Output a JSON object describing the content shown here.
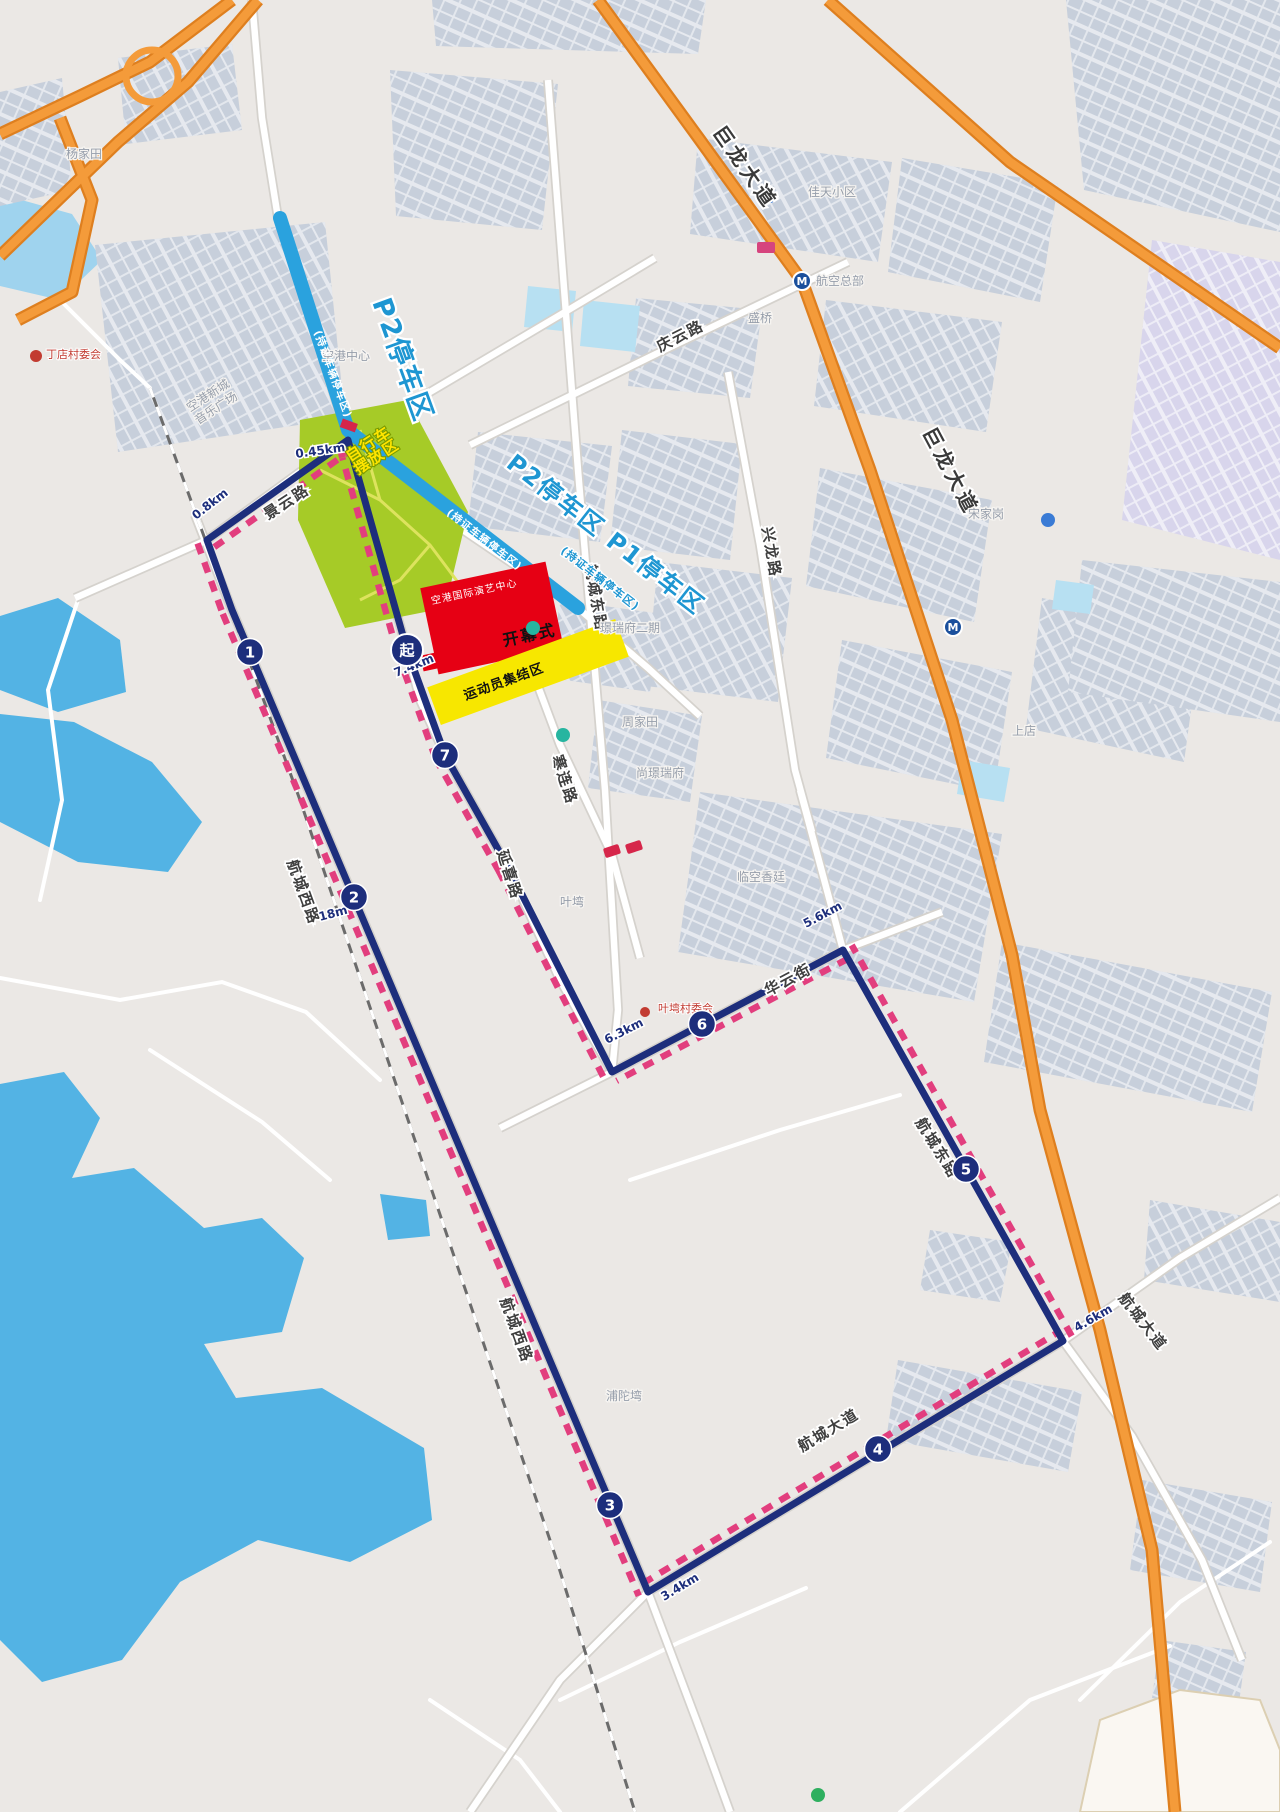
{
  "map_colors": {
    "land": "#ebe8e5",
    "building_zone": "#c7cfdb",
    "building_zone_lavender": "#d8d5ec",
    "water": "#53b3e4",
    "water_light": "#9fd3ee",
    "pond_cell": "#b7e0f2",
    "highway_orange": "#f49b3a",
    "highway_casing": "#de7f1f",
    "route_navy": "#1d2e7c",
    "closure_pink": "#e23e7e",
    "parking_blue": "#2aa2de",
    "park_green": "#a6cb27",
    "ceremony_red": "#e60014",
    "assembly_yellow": "#f7e700",
    "railway_gray": "#6b6b6b"
  },
  "route": {
    "polyline": [
      [
        407,
        650
      ],
      [
        352,
        455
      ],
      [
        348,
        440
      ],
      [
        207,
        540
      ],
      [
        232,
        610
      ],
      [
        648,
        1592
      ],
      [
        1063,
        1341
      ],
      [
        843,
        950
      ],
      [
        612,
        1072
      ],
      [
        508,
        867
      ],
      [
        445,
        755
      ],
      [
        407,
        650
      ]
    ],
    "closure_sides": [
      "L",
      "L",
      "L",
      "R",
      "R",
      "L",
      "R",
      "L",
      "L",
      "L",
      "L"
    ],
    "start_marker": {
      "label": "起",
      "x": 407,
      "y": 650
    },
    "km_markers": [
      {
        "label": "1",
        "x": 250,
        "y": 652
      },
      {
        "label": "2",
        "x": 354,
        "y": 897
      },
      {
        "label": "3",
        "x": 610,
        "y": 1505
      },
      {
        "label": "4",
        "x": 878,
        "y": 1449
      },
      {
        "label": "5",
        "x": 966,
        "y": 1169
      },
      {
        "label": "6",
        "x": 702,
        "y": 1024
      },
      {
        "label": "7",
        "x": 445,
        "y": 755
      }
    ],
    "distance_labels": [
      {
        "text": "0.45km",
        "x": 296,
        "y": 458,
        "angle": -8
      },
      {
        "text": "0.8km",
        "x": 196,
        "y": 520,
        "angle": -38
      },
      {
        "text": "7.4km",
        "x": 396,
        "y": 677,
        "angle": -22
      },
      {
        "text": "18m",
        "x": 320,
        "y": 921,
        "angle": -15
      },
      {
        "text": "6.3km",
        "x": 607,
        "y": 1044,
        "angle": -27
      },
      {
        "text": "5.6km",
        "x": 806,
        "y": 928,
        "angle": -28
      },
      {
        "text": "4.6km",
        "x": 1077,
        "y": 1332,
        "angle": -30
      },
      {
        "text": "3.4km",
        "x": 664,
        "y": 1601,
        "angle": -31
      }
    ]
  },
  "parking": {
    "corridors": [
      {
        "x1": 280,
        "y1": 218,
        "x2": 348,
        "y2": 430,
        "big_label": "P2停车区",
        "big_x": 372,
        "big_y": 302,
        "big_angle": 70,
        "big_size": 27,
        "inner_label": "(持证车辆停车区)",
        "inner_x": 314,
        "inner_y": 332,
        "inner_angle": 70
      },
      {
        "x1": 350,
        "y1": 432,
        "x2": 578,
        "y2": 608,
        "big_label": "P2停车区 P1停车区",
        "big_x": 505,
        "big_y": 466,
        "big_angle": 38,
        "big_size": 24,
        "inner_label": "(持证车辆停车区)",
        "inner_x": 446,
        "inner_y": 514,
        "inner_angle": 38,
        "extra_label": "(持证车辆停车区)",
        "extra_x": 560,
        "extra_y": 552,
        "extra_angle": 38
      }
    ]
  },
  "venues": {
    "park": {
      "name": "香虹公园",
      "x": 382,
      "y": 528,
      "angle": -15
    },
    "bike_zone": {
      "lines": [
        "自行车",
        "摆放区"
      ],
      "x": 350,
      "y": 462,
      "angle": -33
    },
    "ceremony": {
      "name": "开幕式",
      "venue": "空港国际演艺中心",
      "cx": 492,
      "cy": 618,
      "w": 128,
      "h": 88,
      "angle": -12
    },
    "assembly": {
      "name": "运动员集结区",
      "cx": 528,
      "cy": 672,
      "w": 200,
      "h": 40,
      "angle": -20
    }
  },
  "road_labels": [
    {
      "text": "景云路",
      "x": 268,
      "y": 520,
      "angle": -33,
      "big": false
    },
    {
      "text": "航城西路",
      "x": 287,
      "y": 862,
      "angle": 70,
      "big": false
    },
    {
      "text": "航城西路",
      "x": 500,
      "y": 1300,
      "angle": 70,
      "big": false
    },
    {
      "text": "延喜路",
      "x": 497,
      "y": 852,
      "angle": 72,
      "big": false
    },
    {
      "text": "寒连路",
      "x": 552,
      "y": 757,
      "angle": 72,
      "big": false
    },
    {
      "text": "航城东路",
      "x": 585,
      "y": 565,
      "angle": 80,
      "big": false
    },
    {
      "text": "航城东路",
      "x": 915,
      "y": 1122,
      "angle": 58,
      "big": false
    },
    {
      "text": "庆云路",
      "x": 660,
      "y": 352,
      "angle": -27,
      "big": false
    },
    {
      "text": "兴龙路",
      "x": 762,
      "y": 528,
      "angle": 80,
      "big": false
    },
    {
      "text": "华云街",
      "x": 768,
      "y": 996,
      "angle": -28,
      "big": false
    },
    {
      "text": "航城大道",
      "x": 802,
      "y": 1452,
      "angle": -31,
      "big": false
    },
    {
      "text": "航城大道",
      "x": 1118,
      "y": 1298,
      "angle": 52,
      "big": false
    },
    {
      "text": "巨龙大道",
      "x": 712,
      "y": 132,
      "angle": 55,
      "big": true
    },
    {
      "text": "巨龙大道",
      "x": 922,
      "y": 432,
      "angle": 62,
      "big": true
    }
  ],
  "place_labels": [
    {
      "lines": [
        "空港新城",
        "音乐广场"
      ],
      "x": 190,
      "y": 412,
      "angle": -33
    },
    {
      "lines": [
        "空港中心"
      ],
      "x": 322,
      "y": 360,
      "angle": 0
    },
    {
      "lines": [
        "杨家田"
      ],
      "x": 66,
      "y": 158,
      "angle": 0
    },
    {
      "lines": [
        "佳天小区"
      ],
      "x": 808,
      "y": 196,
      "angle": 0
    },
    {
      "lines": [
        "盛桥"
      ],
      "x": 748,
      "y": 322,
      "angle": 0
    },
    {
      "lines": [
        "璟瑞府二期"
      ],
      "x": 600,
      "y": 632,
      "angle": 0
    },
    {
      "lines": [
        "尚璟瑞府"
      ],
      "x": 636,
      "y": 777,
      "angle": 0
    },
    {
      "lines": [
        "周家田"
      ],
      "x": 622,
      "y": 726,
      "angle": 0
    },
    {
      "lines": [
        "叶塆"
      ],
      "x": 560,
      "y": 906,
      "angle": 0
    },
    {
      "lines": [
        "临空香廷"
      ],
      "x": 737,
      "y": 881,
      "angle": 0
    },
    {
      "lines": [
        "上店"
      ],
      "x": 1012,
      "y": 735,
      "angle": 0
    },
    {
      "lines": [
        "浦陀塆"
      ],
      "x": 606,
      "y": 1400,
      "angle": 0
    },
    {
      "lines": [
        "宋家岗"
      ],
      "x": 968,
      "y": 518,
      "angle": 0
    }
  ],
  "poi_labels": [
    {
      "text": "丁店村委会",
      "x": 46,
      "y": 358
    },
    {
      "text": "叶塆村委会",
      "x": 658,
      "y": 1012
    }
  ],
  "transit": {
    "metro": [
      {
        "label": "航空总部",
        "x": 802,
        "y": 281
      },
      {
        "label": "",
        "x": 953,
        "y": 627
      }
    ]
  }
}
